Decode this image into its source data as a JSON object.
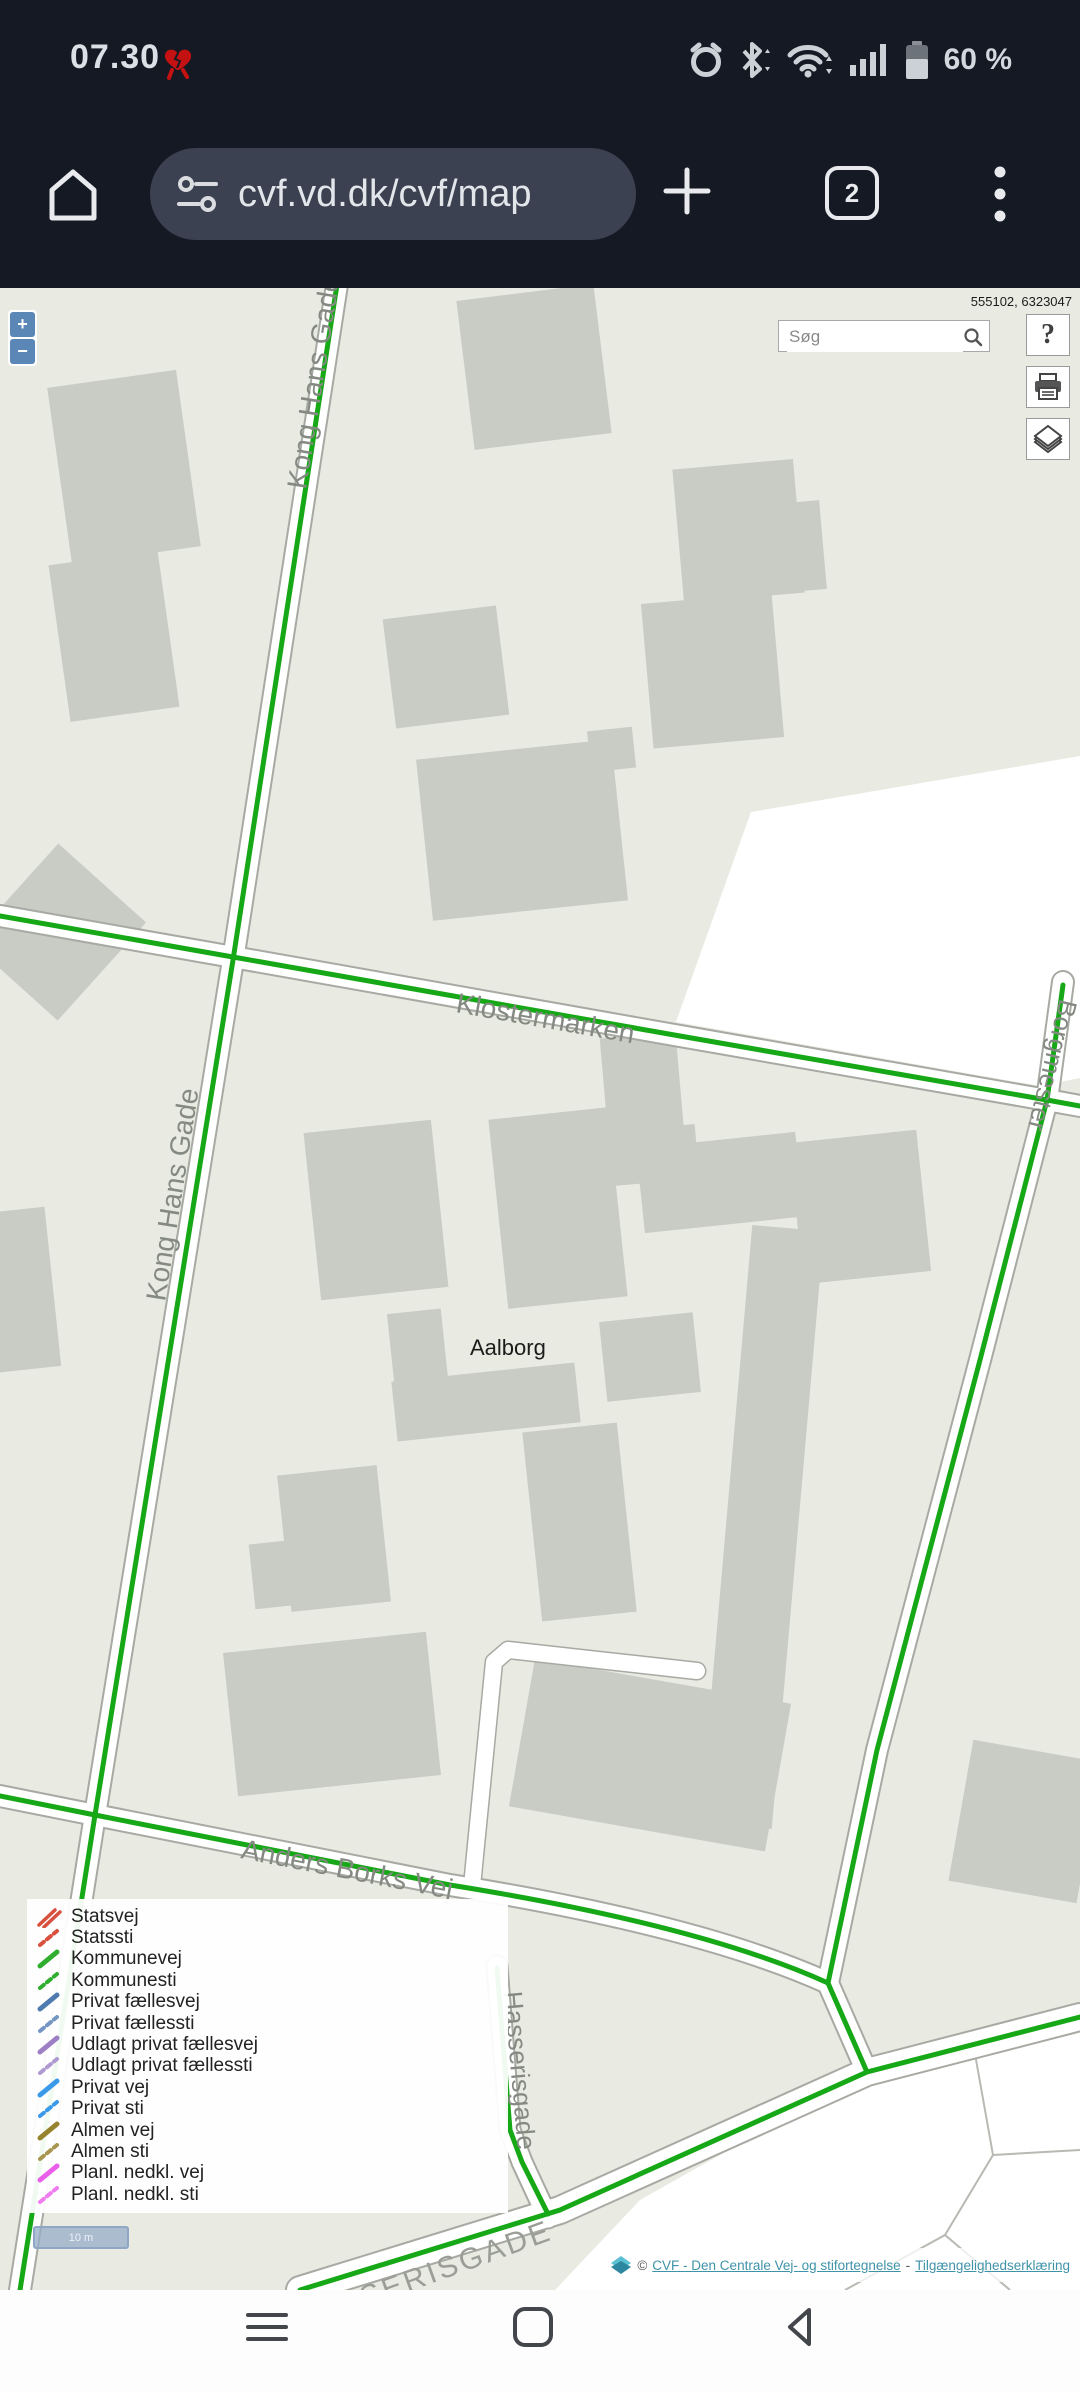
{
  "status_bar": {
    "time": "07.30",
    "battery_text": "60 %"
  },
  "browser": {
    "url": "cvf.vd.dk/cvf/map",
    "tab_count": "2"
  },
  "map": {
    "coordinates": "555102, 6323047",
    "search_placeholder": "Søg",
    "city_label": "Aalborg",
    "streets": {
      "kong_hans_top": "Kong Hans Gade",
      "kong_hans": "Kong Hans Gade",
      "klostermarken": "Klostermarken",
      "anders_borks": "Anders Borks Vej",
      "hasserisgade": "Hasserisgade",
      "borgmester": "Borgmester",
      "district_caps": "HASSERISGADE"
    },
    "road_color": "#16a816"
  },
  "controls": {
    "zoom_in": "+",
    "zoom_out": "−",
    "help": "?"
  },
  "legend": {
    "items": [
      {
        "label": "Statsvej",
        "color": "#d8503e",
        "style": "double"
      },
      {
        "label": "Statssti",
        "color": "#d8503e",
        "style": "dashed"
      },
      {
        "label": "Kommunevej",
        "color": "#2fae2f",
        "style": "solid"
      },
      {
        "label": "Kommunesti",
        "color": "#2fae2f",
        "style": "dashed"
      },
      {
        "label": "Privat fællesvej",
        "color": "#4f7bb0",
        "style": "solid"
      },
      {
        "label": "Privat fællessti",
        "color": "#7595c2",
        "style": "dashed"
      },
      {
        "label": "Udlagt privat fællesvej",
        "color": "#9c7fc4",
        "style": "solid"
      },
      {
        "label": "Udlagt privat fællessti",
        "color": "#af9ad2",
        "style": "dashed"
      },
      {
        "label": "Privat vej",
        "color": "#3a99e8",
        "style": "solid"
      },
      {
        "label": "Privat sti",
        "color": "#3a99e8",
        "style": "dashed"
      },
      {
        "label": "Almen vej",
        "color": "#97822e",
        "style": "solid"
      },
      {
        "label": "Almen sti",
        "color": "#a89550",
        "style": "dashed"
      },
      {
        "label": "Planl. nedkl. vej",
        "color": "#ea5fea",
        "style": "solid"
      },
      {
        "label": "Planl. nedkl. sti",
        "color": "#f07df0",
        "style": "dashed"
      }
    ]
  },
  "scale_bar": "10 m",
  "attribution": {
    "copyright": "©",
    "link_main": "CVF - Den Centrale Vej- og stifortegnelse",
    "separator": "-",
    "link_accessibility": "Tilgængelighedserklæring"
  }
}
